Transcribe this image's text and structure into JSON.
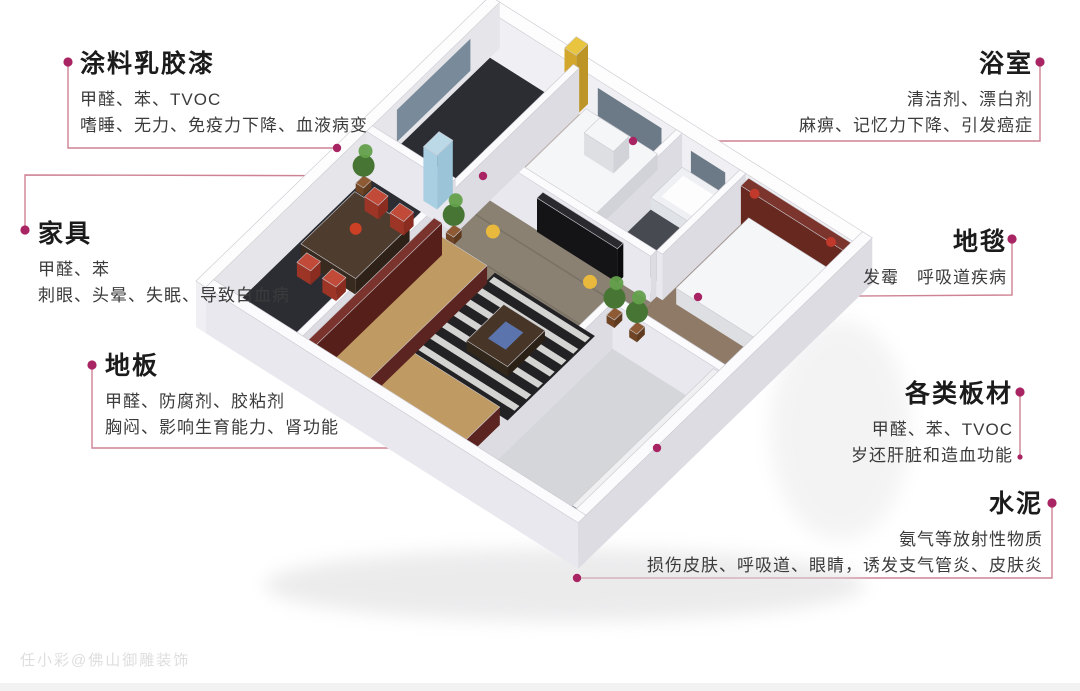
{
  "colors": {
    "connector_line": "#c97487",
    "connector_dot": "#a82462",
    "title": "#1b1b1b",
    "body": "#3b3b3b",
    "background": "#ffffff"
  },
  "watermark": "任小彩@佛山御雕装饰",
  "callouts": {
    "paint": {
      "title": "涂料乳胶漆",
      "lines": [
        "甲醛、苯、TVOC",
        "嗜睡、无力、免疫力下降、血液病变"
      ]
    },
    "bathroom": {
      "title": "浴室",
      "lines": [
        "清洁剂、漂白剂",
        "麻痹、记忆力下降、引发癌症"
      ]
    },
    "furniture": {
      "title": "家具",
      "lines": [
        "甲醛、苯",
        "刺眼、头晕、失眠、导致白血病"
      ]
    },
    "carpet": {
      "title": "地毯",
      "lines": [
        "发霉　呼吸道疾病"
      ]
    },
    "floor": {
      "title": "地板",
      "lines": [
        "甲醛、防腐剂、胶粘剂",
        "胸闷、影响生育能力、肾功能"
      ]
    },
    "boards": {
      "title": "各类板材",
      "lines": [
        "甲醛、苯、TVOC",
        "岁还肝脏和造血功能"
      ]
    },
    "cement": {
      "title": "水泥",
      "lines": [
        "氨气等放射性物质",
        "损伤皮肤、呼吸道、眼睛，诱发支气管炎、皮肤炎"
      ]
    }
  }
}
